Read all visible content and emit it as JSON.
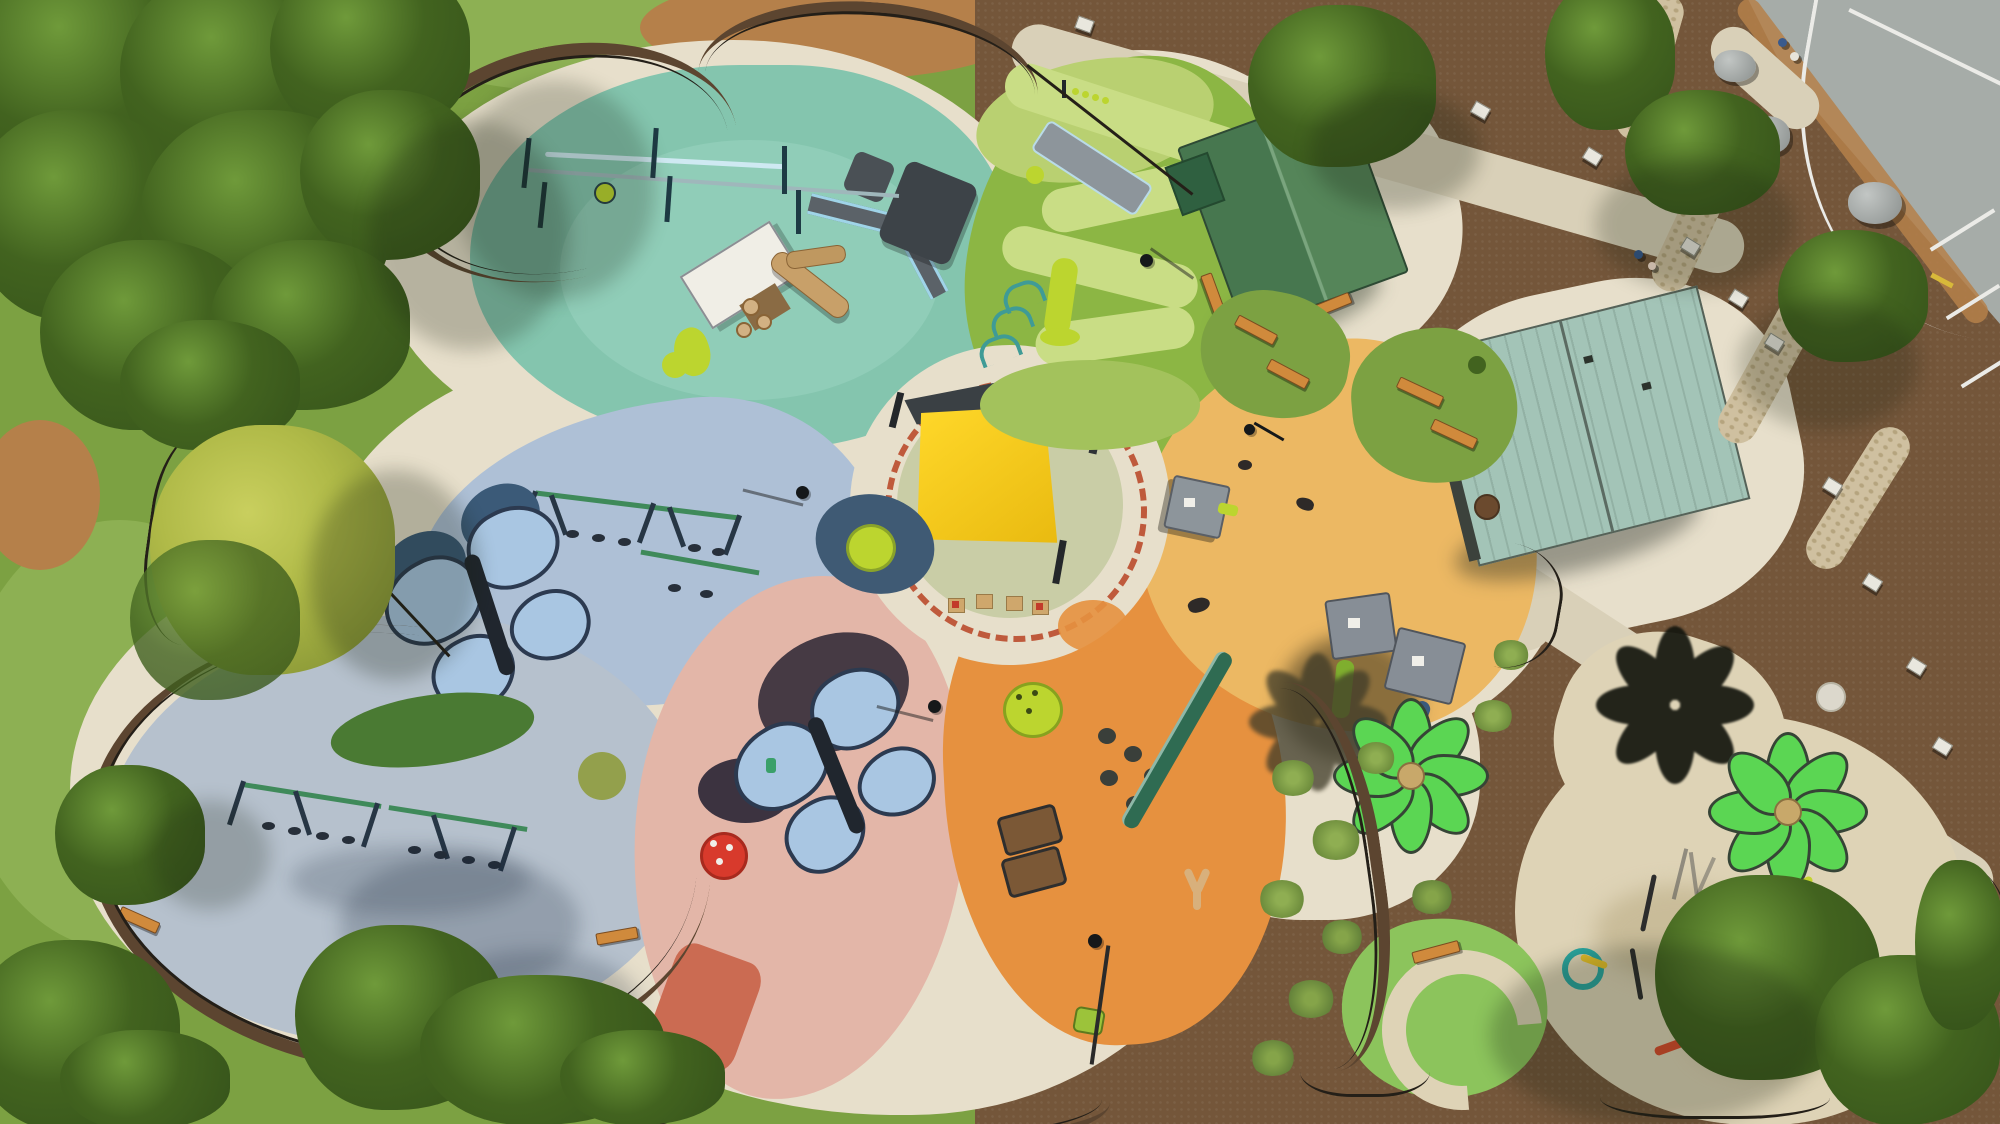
{
  "scene": {
    "type": "aerial-photograph",
    "description": "Top-down drone view of a flower-shaped inclusive playground park on a sunny day. A central circular plaza with a yellow shade sail is ringed by a red-brick dotted border, with colorful rubber-surface petals radiating outward: a teal splash/zip-line petal, a green turf mound with a winding light path and slides, a light-blue petal with a butterfly shade structure and swings, a gray-blue petal with two swing bays, a salmon petal with a second butterfly shade and red mushroom, a deep-orange toddler petal, and a light-orange petal with playhouses. Two bright-green flower-shaped shade sails stand over a splash pad at lower right, casting flower-shaped shadows. A green-roof picnic pavilion and a teal-roof restroom building sit on the right, surrounded by brown mulch beds, rock-lined swale, interpretive signs, sidewalks, lawn, mature trees, and a gray road corner with white markings at top right.",
    "time_of_day": "midday, long shadows to the southwest",
    "visible_text": ""
  },
  "palette": {
    "grass-base": "#7ca142",
    "grass-light": "#8db053",
    "grass-dark": "#6c9138",
    "dirt": "#b5804a",
    "mulch": "#74563a",
    "mulch-dark": "#5c4530",
    "concrete": "#e7dfcb",
    "concrete-dark": "#cbc5ae",
    "sidewalk": "#d9d0b8",
    "splash-concrete": "#ded3b6",
    "splash-stain": "#c9bc99",
    "road": "#a6aca8",
    "road-line": "#ebebe7",
    "teal-petal": "#84c5ae",
    "teal-light": "#90cdb8",
    "green-mound": "#8cb644",
    "mound-path": "#c9dd85",
    "mound-light": "#b9d071",
    "blue-petal": "#aec0d6",
    "grayblue-petal": "#b6c1cd",
    "pink-petal": "#e3b6a8",
    "pink-accent": "#cb6b52",
    "orange-petal": "#e6913f",
    "tan-petal": "#ecb863",
    "ring-sage": "#c9cda6",
    "ring-dash": "#bf5a3c",
    "sail-yellow": "#f5c91d",
    "sail-dark": "#3a4044",
    "butterfly-wing": "#a9c6e2",
    "butterfly-dark": "#2c3a50",
    "butterfly-shade": "#3b5a78",
    "flower-green": "#5bd653",
    "flower-outline": "#364436",
    "flower-shadow": "#15170f",
    "pavilion-roof": "#4d7f55",
    "pavilion-roof-light": "#7aa57e",
    "restroom-roof": "#a3c4b7",
    "wall-dark": "#3c423c",
    "tree-dark": "#35521a",
    "tree-mid": "#42631f",
    "tree-light": "#6f9a3a",
    "tree-yellow": "#b0ba48",
    "fence": "#241f18",
    "equip-green": "#3f8a5a",
    "equip-navy": "#273645",
    "equip-lime": "#bcd52f",
    "equip-teal": "#3f9b96",
    "equip-gray": "#8d959b",
    "bench-wood": "#d08a3c",
    "log-wood": "#c8a069",
    "rock": "#9fa5a3",
    "rock-bed": "#cfc0a0",
    "white": "#f0efe9",
    "shadow": "rgba(22,32,14,0.42)",
    "shade-cool": "rgba(25,35,55,0.22)"
  },
  "regions": [
    {
      "id": "center-circle",
      "label": "central plaza circle with yellow shade sail and toddler tables",
      "color": "ring-sage"
    },
    {
      "id": "teal-petal",
      "label": "teal splash petal with zip line, timber playhouse, log climbers, lime spiral slide",
      "color": "teal-petal"
    },
    {
      "id": "green-mound",
      "label": "turf mound petal with winding path, embankment slide, lime slide, climbing arches",
      "color": "green-mound"
    },
    {
      "id": "blue-petal",
      "label": "light blue petal with butterfly shade structure and swing row",
      "color": "blue-petal"
    },
    {
      "id": "grayblue-petal",
      "label": "gray-blue petal with double swing bays and benches",
      "color": "grayblue-petal"
    },
    {
      "id": "pink-petal",
      "label": "salmon petal with butterfly shade, red mushroom, lime dome climber",
      "color": "pink-petal"
    },
    {
      "id": "orange-petal",
      "label": "deep orange petal with caterpillar climber, pods, balance beam, wavy climbers",
      "color": "orange-petal"
    },
    {
      "id": "tan-petal",
      "label": "light orange petal with playhouses and animal figures",
      "color": "tan-petal"
    },
    {
      "id": "splash-pad",
      "label": "splash pad with water play features under green flower shades",
      "color": "splash-concrete"
    },
    {
      "id": "green-splash-zone",
      "label": "green rubber zone with cream loop path and bench",
      "color": "grass-light"
    },
    {
      "id": "mulch-beds",
      "label": "brown mulch planting beds with boulders, rock swale, signs, trees",
      "color": "mulch"
    },
    {
      "id": "road",
      "label": "gray road corner with white pavement markings",
      "color": "road"
    },
    {
      "id": "lawn",
      "label": "surrounding mowed lawn with bare dirt patches",
      "color": "grass-base"
    }
  ],
  "structures": {
    "shade_sails": [
      "central yellow square sail with dark canopy panel",
      "two bright green 8-petal flower shades",
      "one black flower-shaped shadow on mulch",
      "two blue butterfly-shaped shades"
    ],
    "buildings": [
      "green gable-roof picnic pavilion with small green kiosk",
      "teal standing-seam roof restroom building"
    ],
    "site_furnishings": [
      "orange park benches",
      "interpretive signs",
      "lamp posts",
      "white utility disc",
      "gray boulders",
      "black perimeter fence"
    ],
    "people_visible": 4
  }
}
